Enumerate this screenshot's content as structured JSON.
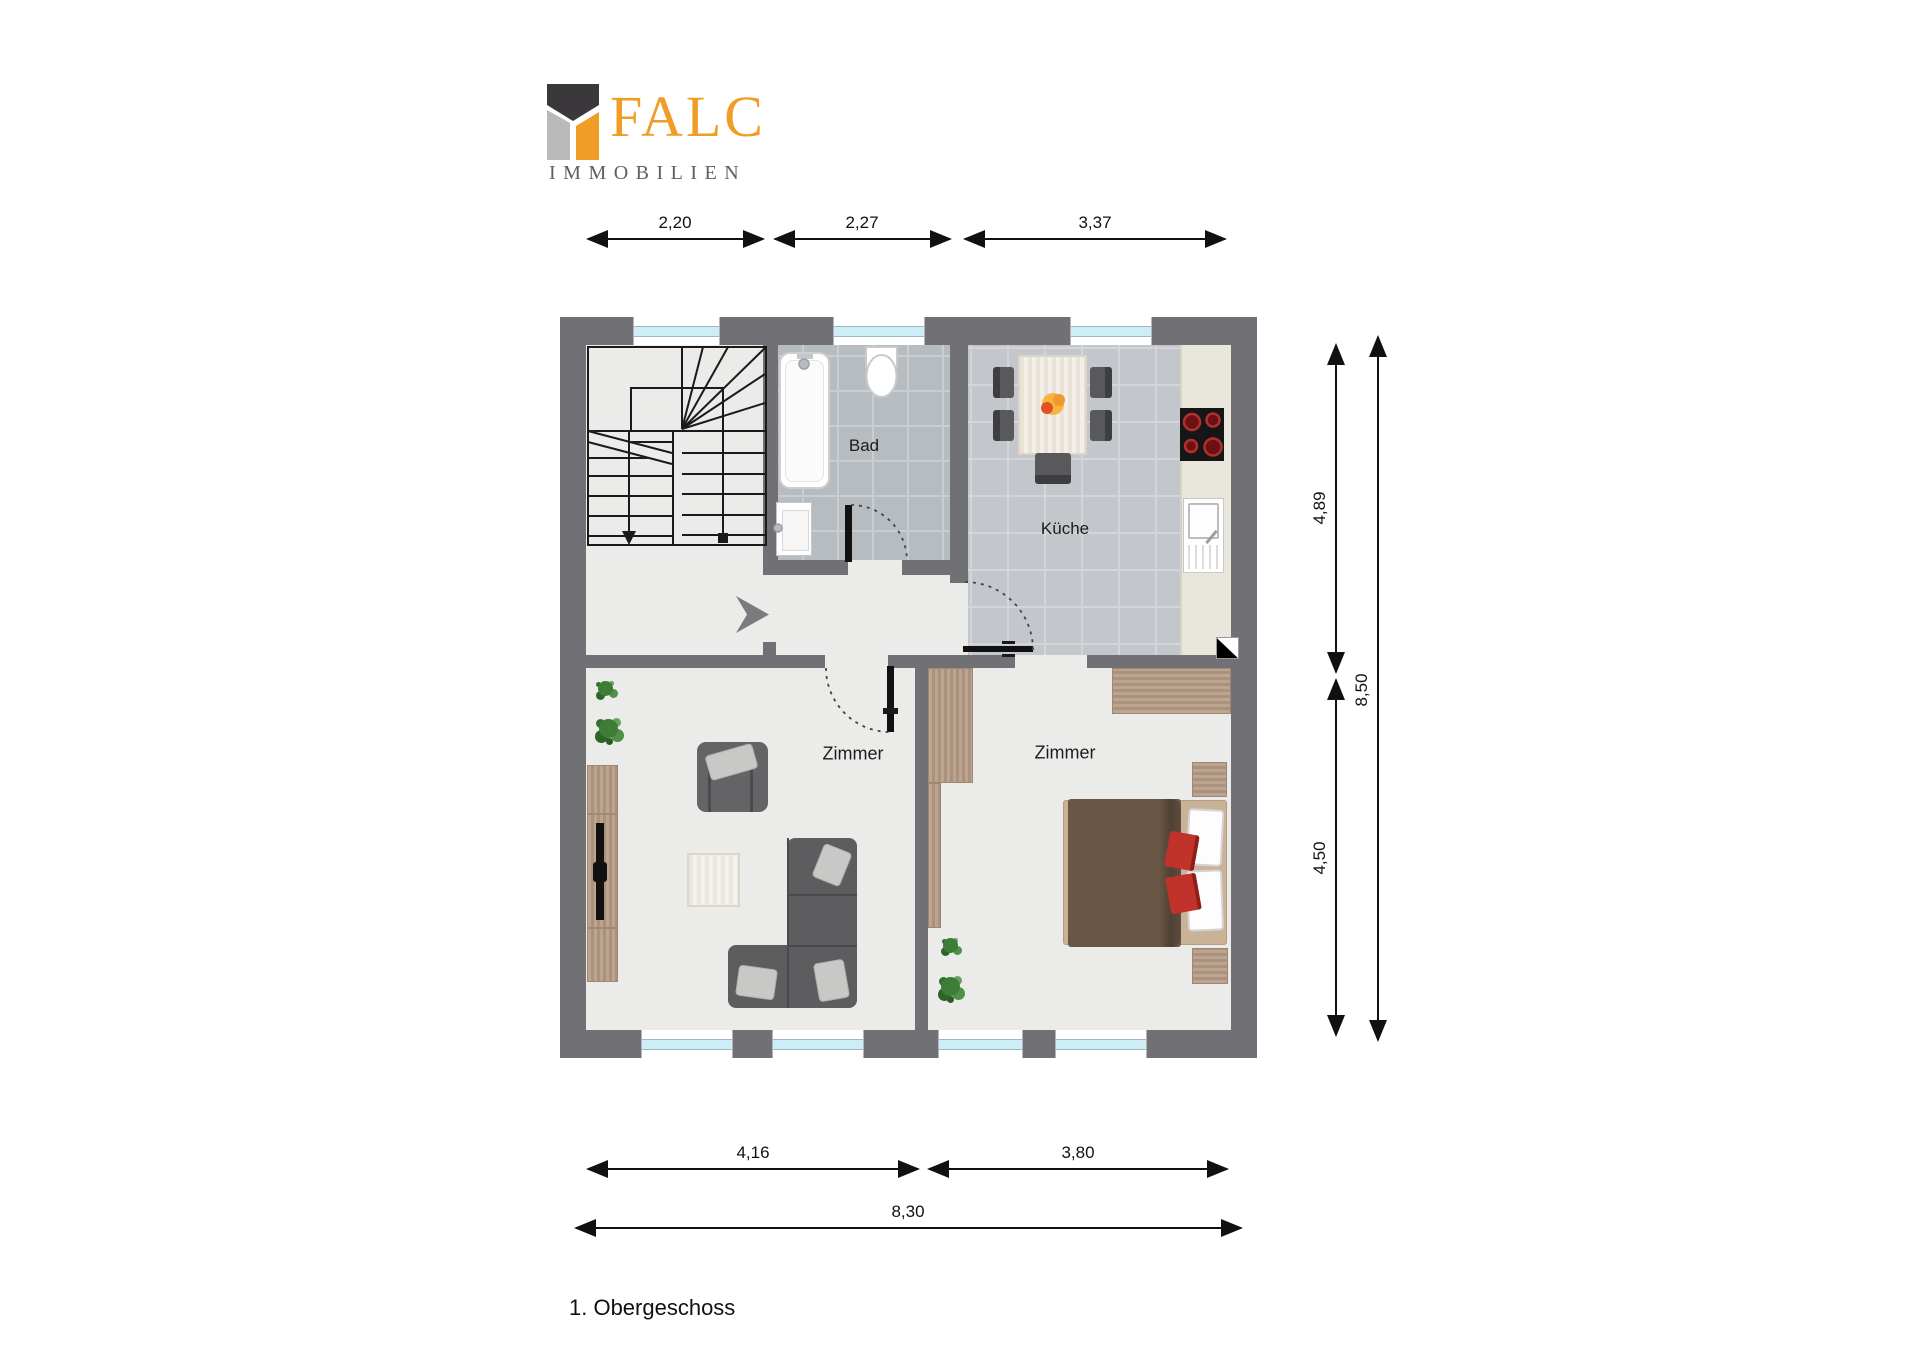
{
  "logo": {
    "brand": "FALC",
    "tagline": "IMMOBILIEN"
  },
  "title": "1. Obergeschoss",
  "rooms": {
    "bath": "Bad",
    "kitchen": "Küche",
    "room_left": "Zimmer",
    "room_right": "Zimmer"
  },
  "dimensions": {
    "top": [
      "2,20",
      "2,27",
      "3,37"
    ],
    "right": [
      "4,89",
      "4,50",
      "8,50"
    ],
    "bottom": [
      "4,16",
      "3,80",
      "8,30"
    ]
  },
  "colors": {
    "wall": "#717074",
    "floor": "#ebebe9",
    "tile_bath": "#b7bcc1",
    "tile_kitchen": "#c3c7cc",
    "window_glass": "#cdeef6",
    "wood": "#b49a84",
    "counter": "#e9e7db",
    "sofa_gray": "#5d5d60",
    "bed_duvet": "#695645",
    "cushion_red": "#c0392b",
    "brand_orange": "#ef9d24",
    "brand_dark": "#3a383b",
    "brand_gray": "#b9b8ba"
  }
}
